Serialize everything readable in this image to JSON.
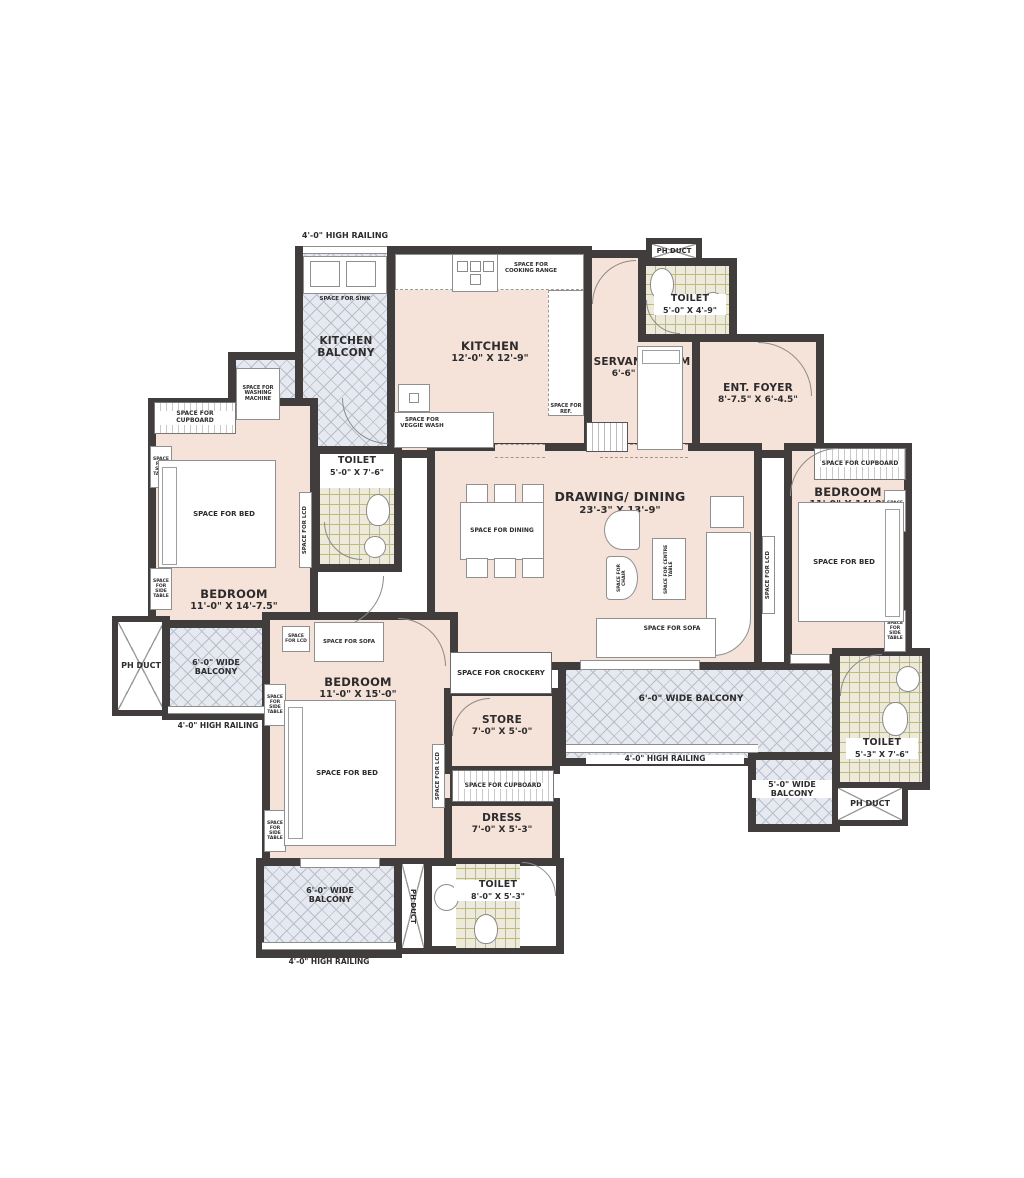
{
  "colors": {
    "floor": "#f5e2d8",
    "wall": "#413d3d",
    "balcony_hatch": "#e6e9f0",
    "toilet_tile": "#edeada"
  },
  "labels": {
    "high_railing": "4'-0\" HIGH RAILING",
    "ph_duct": "PH DUCT",
    "sink": "SPACE FOR SINK",
    "cooking_range": "SPACE FOR COOKING RANGE",
    "veggie_wash": "SPACE FOR VEGGIE WASH",
    "ref": "SPACE FOR REF.",
    "washing_machine": "SPACE FOR WASHING MACHINE",
    "cupboard": "SPACE FOR CUPBOARD",
    "side_table": "SPACE FOR SIDE TABLE",
    "bed": "SPACE FOR BED",
    "lcd": "SPACE FOR LCD",
    "dining": "SPACE FOR DINING",
    "chair": "SPACE FOR CHAIR",
    "centre_table": "SPACE FOR CENTRE TABLE",
    "sofa": "SPACE FOR SOFA",
    "crockery": "SPACE FOR CROCKERY"
  },
  "rooms": {
    "kitchen_balcony": {
      "name": "KITCHEN BALCONY"
    },
    "kitchen": {
      "name": "KITCHEN",
      "dims": "12'-0\" X 12'-9\""
    },
    "servant_room": {
      "name": "SERVANT ROOM",
      "dims": "6'-6\" X 7'-0\""
    },
    "toilet_top": {
      "name": "TOILET",
      "dims": "5'-0\" X 4'-9\""
    },
    "ent_foyer": {
      "name": "ENT. FOYER",
      "dims": "8'-7.5\" X 6'-4.5\""
    },
    "bedroom_left": {
      "name": "BEDROOM",
      "dims": "11'-0\" X 14'-7.5\""
    },
    "toilet_left": {
      "name": "TOILET",
      "dims": "5'-0\" X 7'-6\""
    },
    "drawing_dining": {
      "name": "DRAWING/ DINING",
      "dims": "23'-3\" X 13'-9\""
    },
    "bedroom_right": {
      "name": "BEDROOM",
      "dims": "11'-0\" X 14'-0\""
    },
    "balcony_left": {
      "name": "6'-0\" WIDE BALCONY"
    },
    "bedroom_bottom": {
      "name": "BEDROOM",
      "dims": "11'-0\" X 15'-0\""
    },
    "store": {
      "name": "STORE",
      "dims": "7'-0\" X 5'-0\""
    },
    "dress": {
      "name": "DRESS",
      "dims": "7'-0\" X 5'-3\""
    },
    "balcony_mid": {
      "name": "6'-0\" WIDE BALCONY"
    },
    "toilet_right": {
      "name": "TOILET",
      "dims": "5'-3\" X 7'-6\""
    },
    "balcony_right_small": {
      "name": "5'-0\" WIDE BALCONY"
    },
    "balcony_bottom": {
      "name": "6'-0\" WIDE BALCONY"
    },
    "toilet_bottom": {
      "name": "TOILET",
      "dims": "8'-0\" X 5'-3\""
    }
  }
}
